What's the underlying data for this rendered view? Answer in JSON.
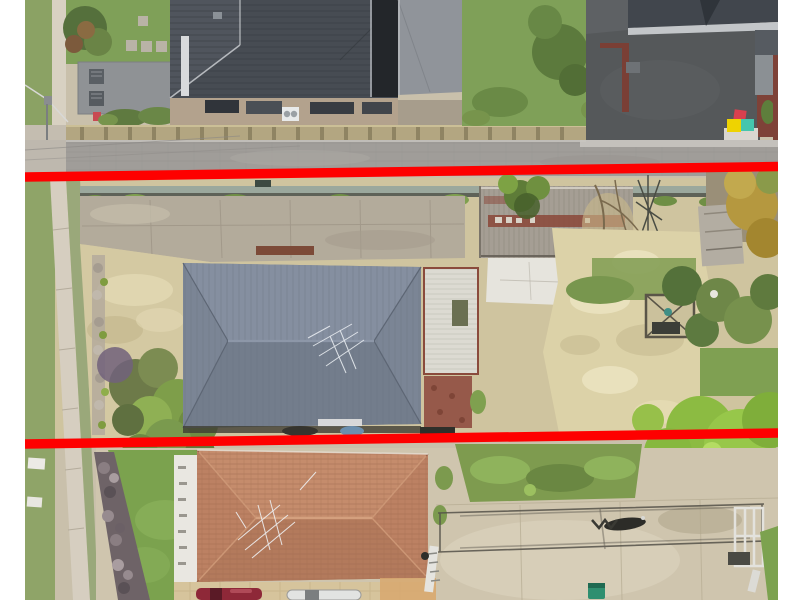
{
  "meta": {
    "type": "aerial-drone-photo",
    "scene": "residential-properties-with-boundary-annotation"
  },
  "annotation": {
    "line_color": "#fe0000",
    "line_count": "2"
  },
  "scene": {
    "background": "#ffffff",
    "colors": {
      "top_roof": "#474c53",
      "top_roof_solar": "#23262a",
      "garage_grey": "#8f9295",
      "terrace_brick": "#b3a28d",
      "street_wall": "#b3a681",
      "road": "#a09d99",
      "footpath": "#d6cec0",
      "asphalt_driveway": "#55585a",
      "lawn": "#7fa058",
      "bin_red": "#d9404e",
      "bin_yellow": "#eed301",
      "bin_teal": "#45c6ad",
      "concrete_apron": "#b3ab9b",
      "dry_yard": "#d4c9a2",
      "subject_roof": "#7b8595",
      "subject_roof_top_facet": "#858fa0",
      "subject_roof_bottom_facet": "#737d8c",
      "white_garage": "#dcdad2",
      "brick_paving": "#96594a",
      "old_shed": "#a59e94",
      "shed_rust": "#8a4638",
      "white_roof": "#e6e4dd",
      "sandy_yard": "#dcd2a8",
      "olive_tree": "#6e8748",
      "autumn_tree": "#b5983f",
      "bright_tree": "#97c74a",
      "rock_garden": "#6e6367",
      "rear_roof": "#bc8163",
      "rear_roof_top_facet": "#c58c6c",
      "rear_roof_bottom_facet": "#b37a5c",
      "side_path_white": "#e9e7e1",
      "rear_driveway": "#cfc5ae",
      "pavement": "#d6c49c",
      "car_maroon": "#8e2838",
      "car_white": "#e2e3e2",
      "green_bin": "#2f8f70",
      "net_shadow": "#55524a"
    }
  }
}
